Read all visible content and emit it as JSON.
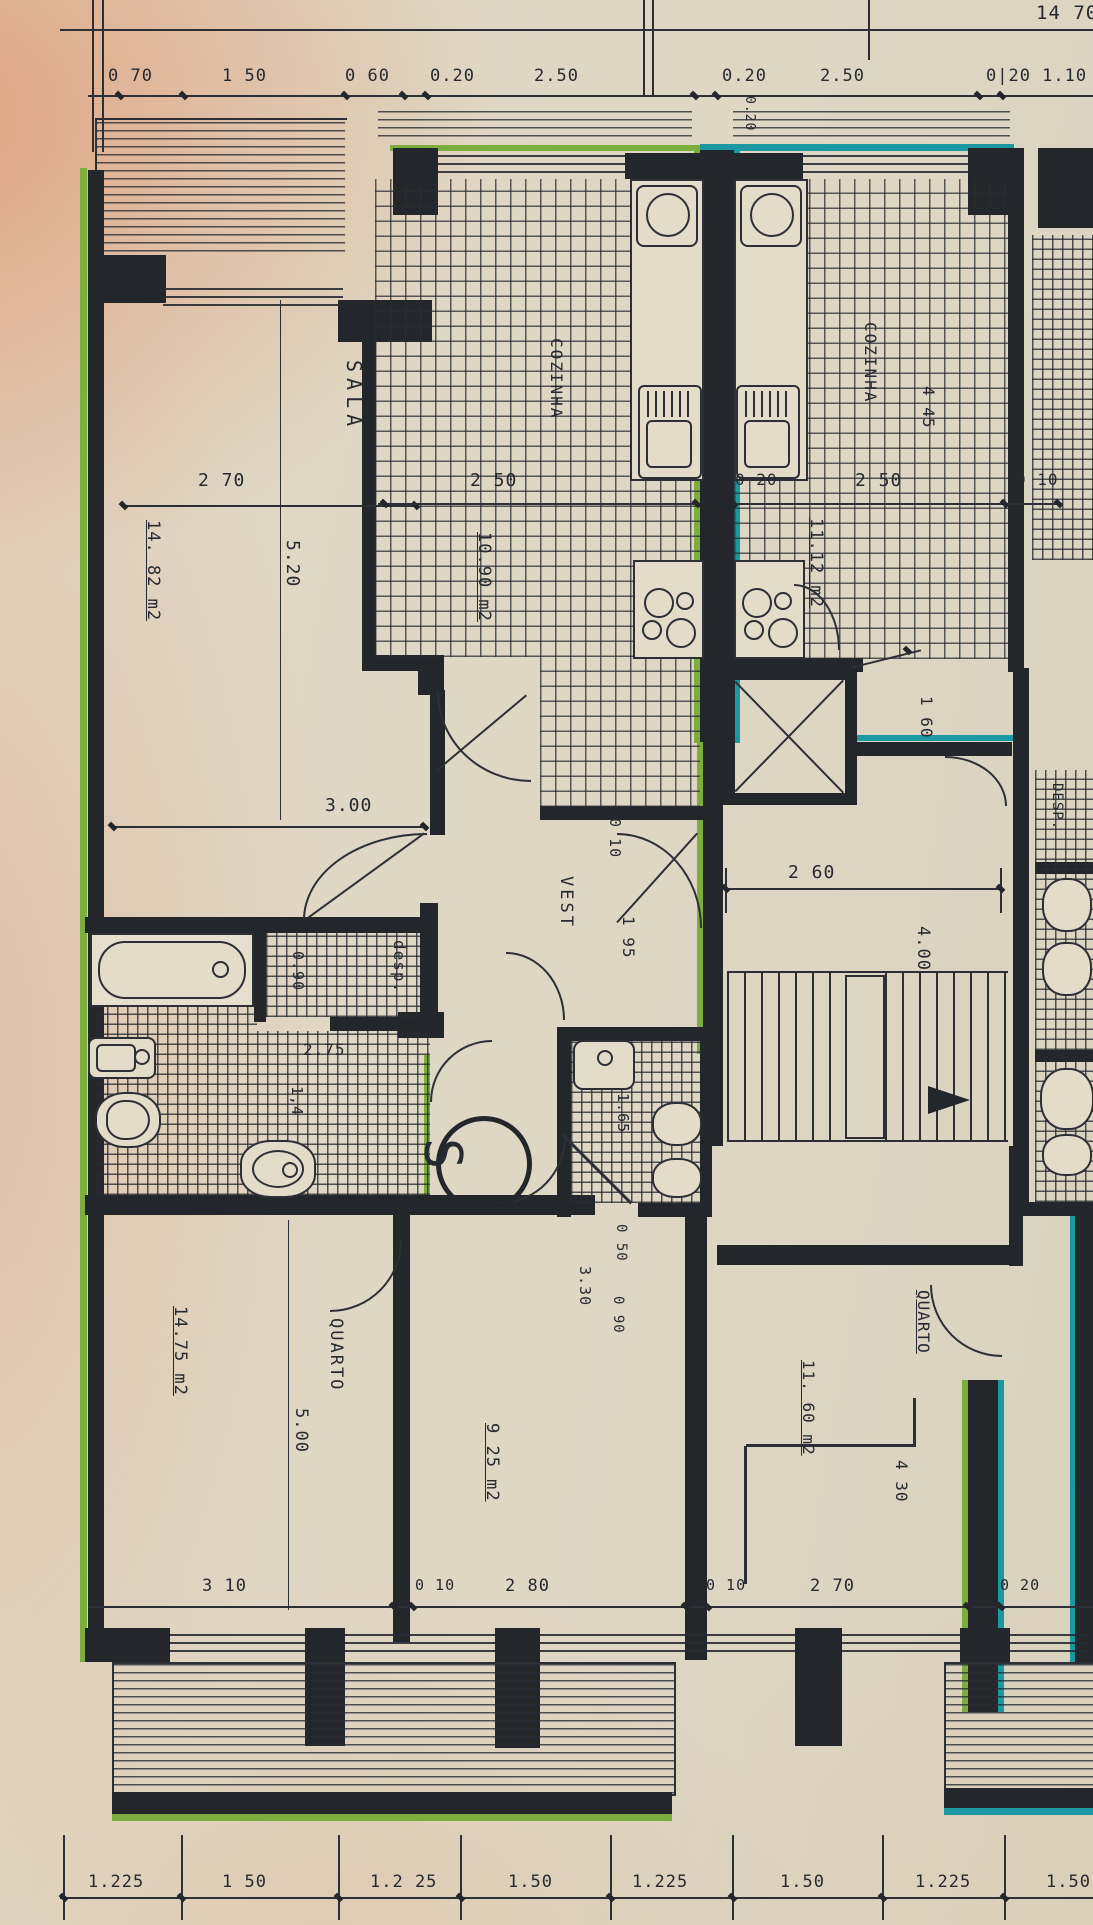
{
  "colors": {
    "ink": "#23262b",
    "green": "#7cae3e",
    "teal": "#1b98a2",
    "paper": "#ded7c4",
    "paper_pink": "#e2a27c"
  },
  "texts": {
    "overall_top": "14 70",
    "tc1": "0 70",
    "tc2": "1 50",
    "tc3": "0 60",
    "tc4": "0.20",
    "tc5": "2.50",
    "tc6": "0.20",
    "tc7": "2.50",
    "tc8": "0|20 1.10",
    "tc_small": "0.20",
    "sala": "SALA",
    "sala_area": "14. 82 m2",
    "sala_w": "2 70",
    "sala_d": "5.20",
    "sala_w2": "3.00",
    "coz_l": "COZINHA",
    "coz_l_area": "10.90 m2",
    "coz_l_w": "2 50",
    "coz_r": "COZINHA",
    "coz_r_area": "11.12 m2",
    "coz_r_w": "2 50",
    "coz_r_wall": "0 20",
    "coz_r_edge": "0 10",
    "coz_r_d": "4 45",
    "coz_r_pass": "1 60",
    "vest": "VEST",
    "vest_wall": "0 10",
    "vest_w": "1 95",
    "stair_w": "2 60",
    "stair_d": "4.00",
    "stair_sym": "S",
    "desp": "desp.",
    "desp_w": "0.90",
    "bath_w": "2.75",
    "bath_d": "1,4",
    "bath2_w": "1.65",
    "bath2_d1": "0 50",
    "bath2_d2": "0 90",
    "q1": "QUARTO",
    "q1_area": "14.75 m2",
    "q1_d": "5.00",
    "q1_w": "3 10",
    "q2_area": "9 25 m2",
    "q2_d": "3.30",
    "q2_w": "2 80",
    "q2_wall": "0 10",
    "q3": "QUARTO",
    "q3_area": "11. 60 m2",
    "q3_d": "4 30",
    "q3_w": "2 70",
    "q3_wall": "0 10",
    "q3_wall2": "0 20",
    "desp_r": "DESP.",
    "nb_d": "4 30",
    "bc1": "1.225",
    "bc2": "1 50",
    "bc3": "1.2 25",
    "bc4": "1.50",
    "bc5": "1.225",
    "bc6": "1.50",
    "bc7": "1.225",
    "bc8": "1.50"
  }
}
